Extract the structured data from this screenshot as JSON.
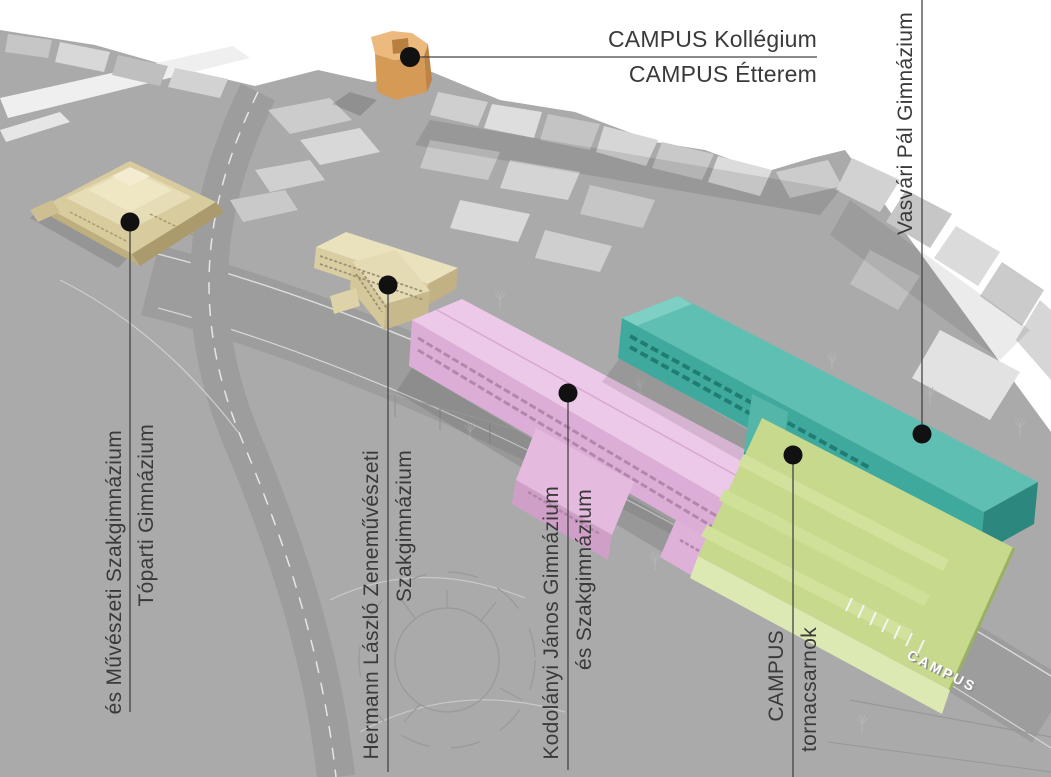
{
  "annotations": {
    "kollegium": {
      "line1": "CAMPUS Kollégium",
      "line2": "CAMPUS Étterem"
    },
    "vasvari": {
      "line1": "Vasvári Pál Gimnázium"
    },
    "toparti": {
      "line1": "Tóparti Gimnázium",
      "line2": "és Művészeti Szakgimnázium"
    },
    "hermann": {
      "line1": "Hermann László Zeneművészeti",
      "line2": "Szakgimnázium"
    },
    "kodolanyi": {
      "line1": "Kodolányi János Gimnázium",
      "line2": "és Szakgimnázium"
    },
    "tornacsarnok": {
      "line1": "CAMPUS",
      "line2": "tornacsarnok"
    },
    "building_sign": {
      "text": "CAMPUS"
    }
  },
  "colors": {
    "kollegium_orange": "#ecba7e",
    "toparti_beige": "#d8cb9e",
    "hermann_beige": "#eae1bd",
    "kodolanyi_pink": "#ecc9e8",
    "vasvari_teal": "#5fbfb3",
    "tornacsarnok_green": "#c6d98c",
    "annotation_text": "#3a3a3a",
    "leader_line": "#444444",
    "dot": "#111111",
    "ground_gray": "#aaaaaa"
  }
}
